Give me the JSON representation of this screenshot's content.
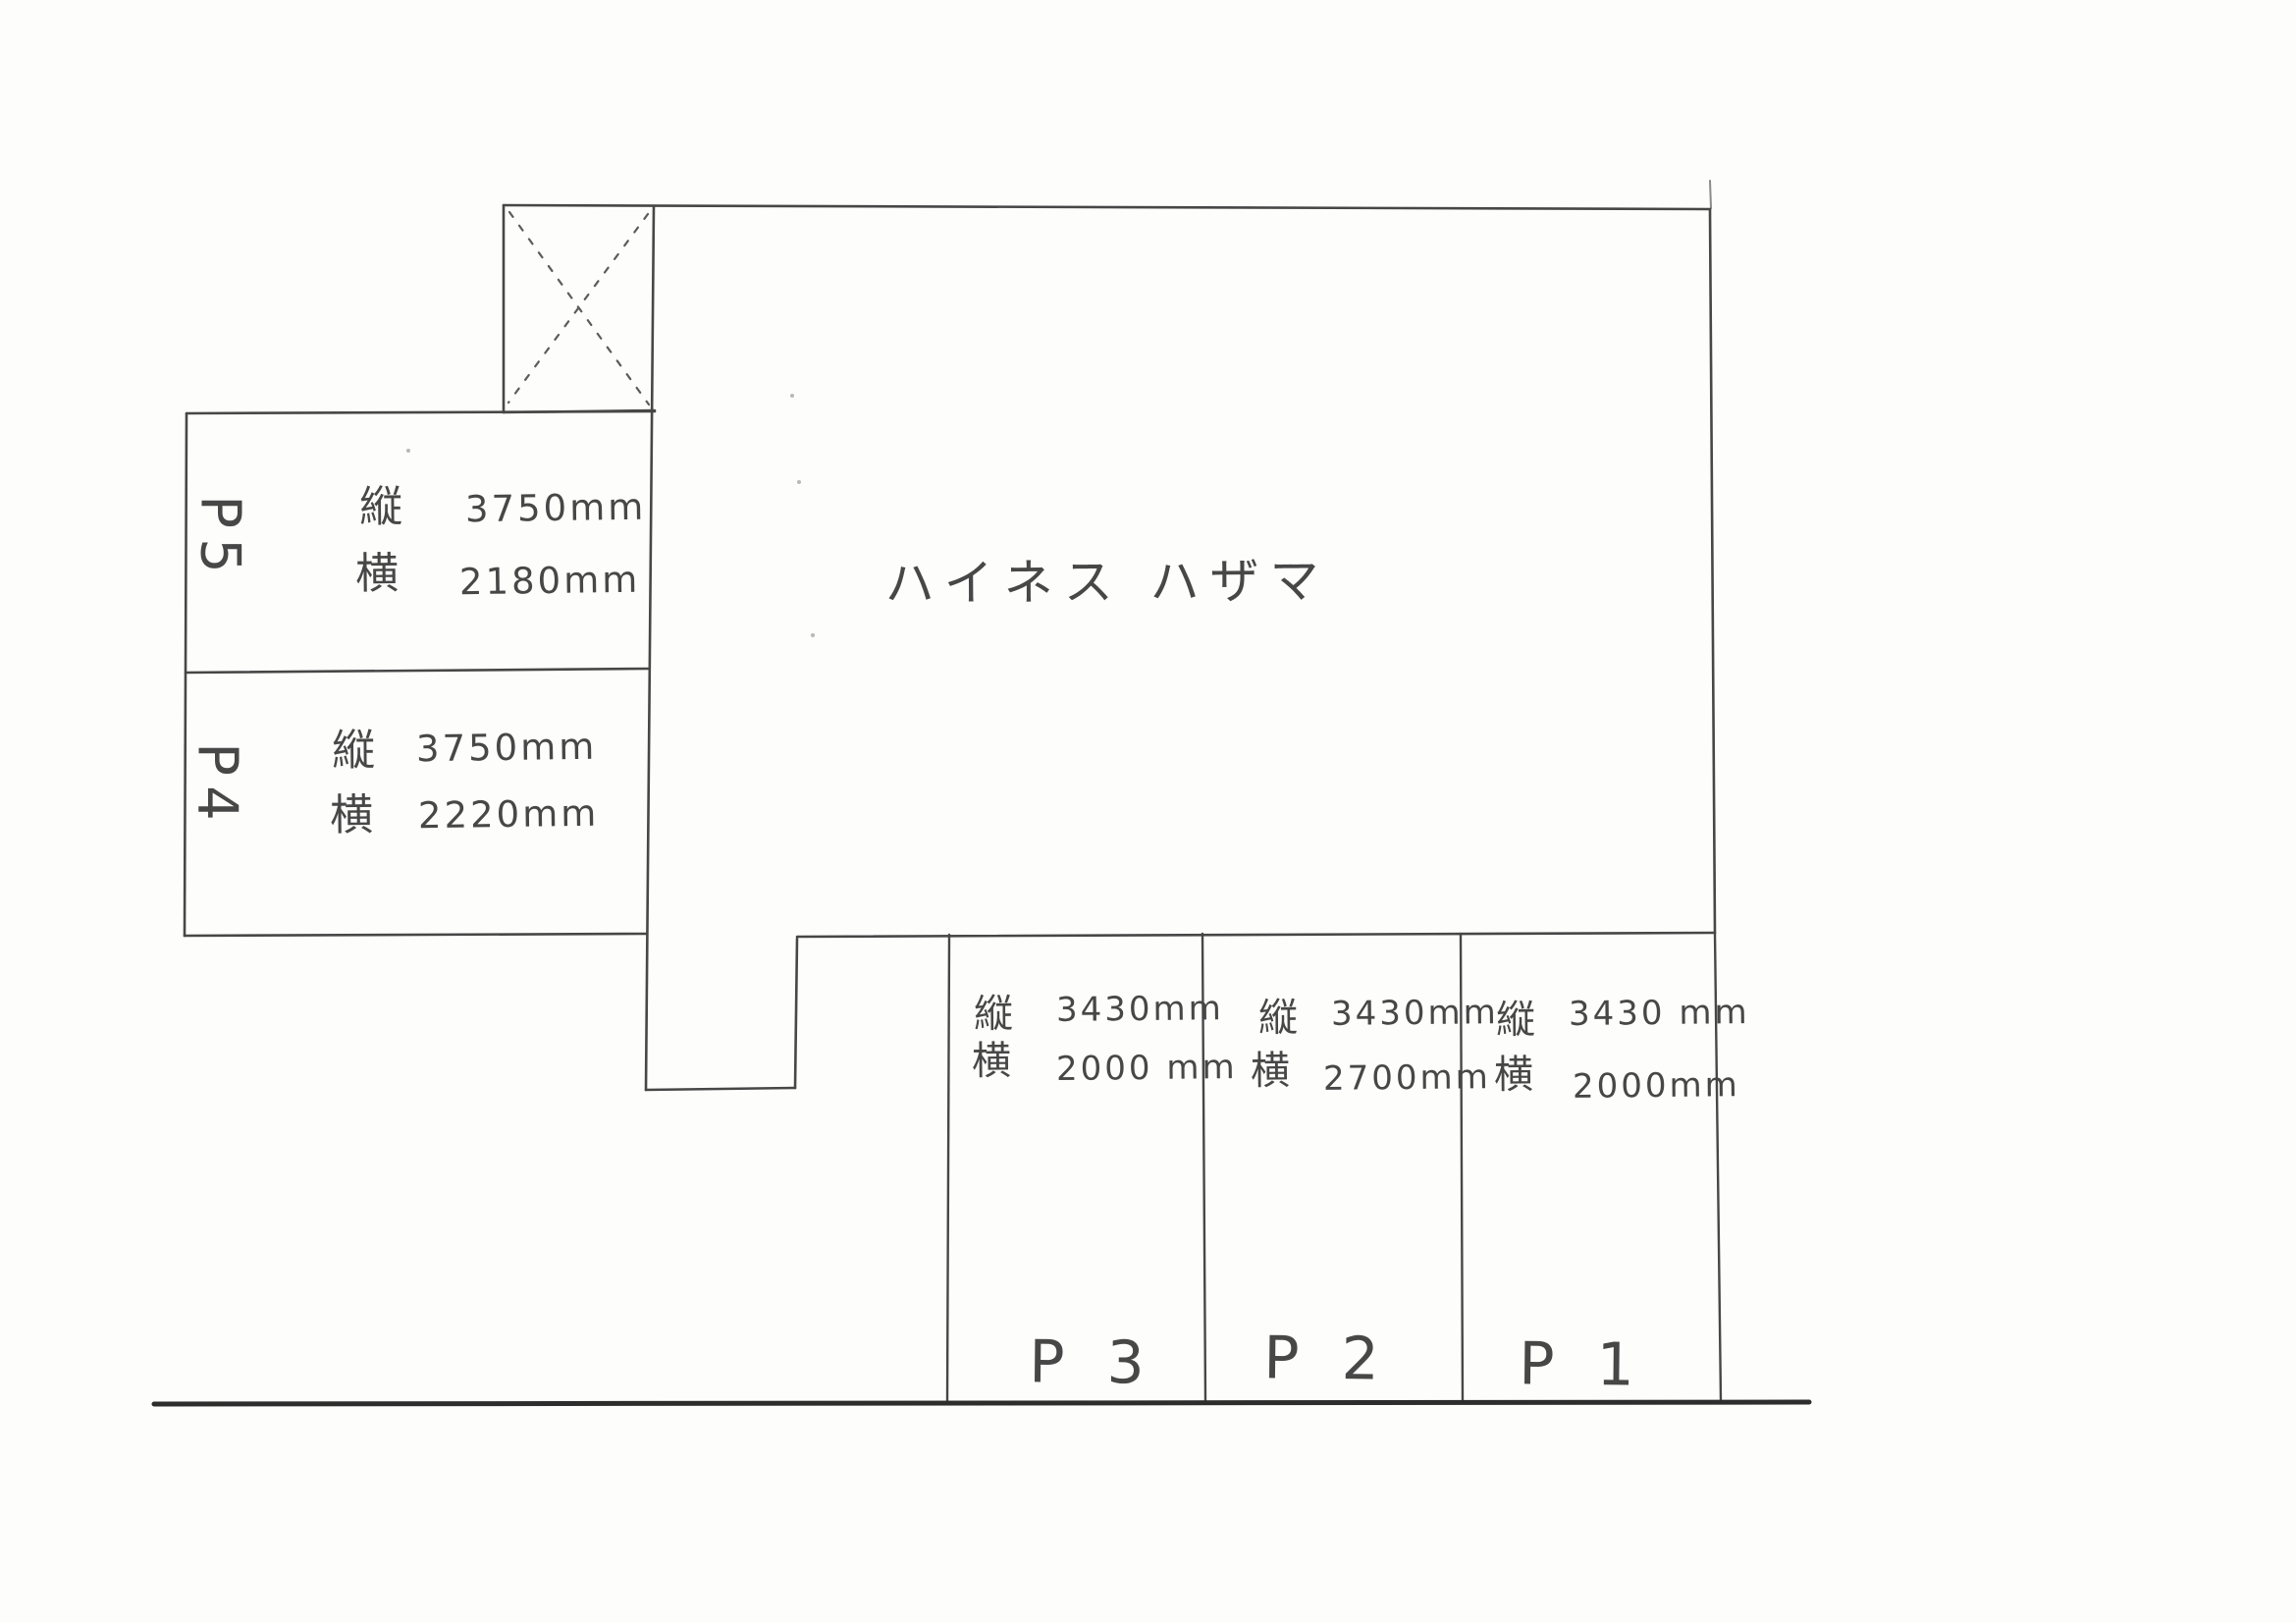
{
  "document": {
    "type_note": "hand-drawn parking layout sketch",
    "building_name": "ハイネス ハザマ"
  },
  "colors": {
    "pencil": "#474747",
    "road_line": "#2d2d2d",
    "paper": "#fdfdfc"
  },
  "spaces": [
    {
      "id": "P5",
      "label": "P5",
      "dims": [
        {
          "k": "縦",
          "v": "3750mm"
        },
        {
          "k": "横",
          "v": "2180mm"
        }
      ]
    },
    {
      "id": "P4",
      "label": "P4",
      "dims": [
        {
          "k": "縦",
          "v": "3750mm"
        },
        {
          "k": "横",
          "v": "2220mm"
        }
      ]
    },
    {
      "id": "P3",
      "label": "P 3",
      "dims": [
        {
          "k": "縦",
          "v": "3430mm"
        },
        {
          "k": "横",
          "v": "2000 mm"
        }
      ]
    },
    {
      "id": "P2",
      "label": "P 2",
      "dims": [
        {
          "k": "縦",
          "v": "3430mm"
        },
        {
          "k": "横",
          "v": "2700mm"
        }
      ]
    },
    {
      "id": "P1",
      "label": "P 1",
      "dims": [
        {
          "k": "縦",
          "v": "3430 mm"
        },
        {
          "k": "横",
          "v": "2000mm"
        }
      ]
    }
  ]
}
